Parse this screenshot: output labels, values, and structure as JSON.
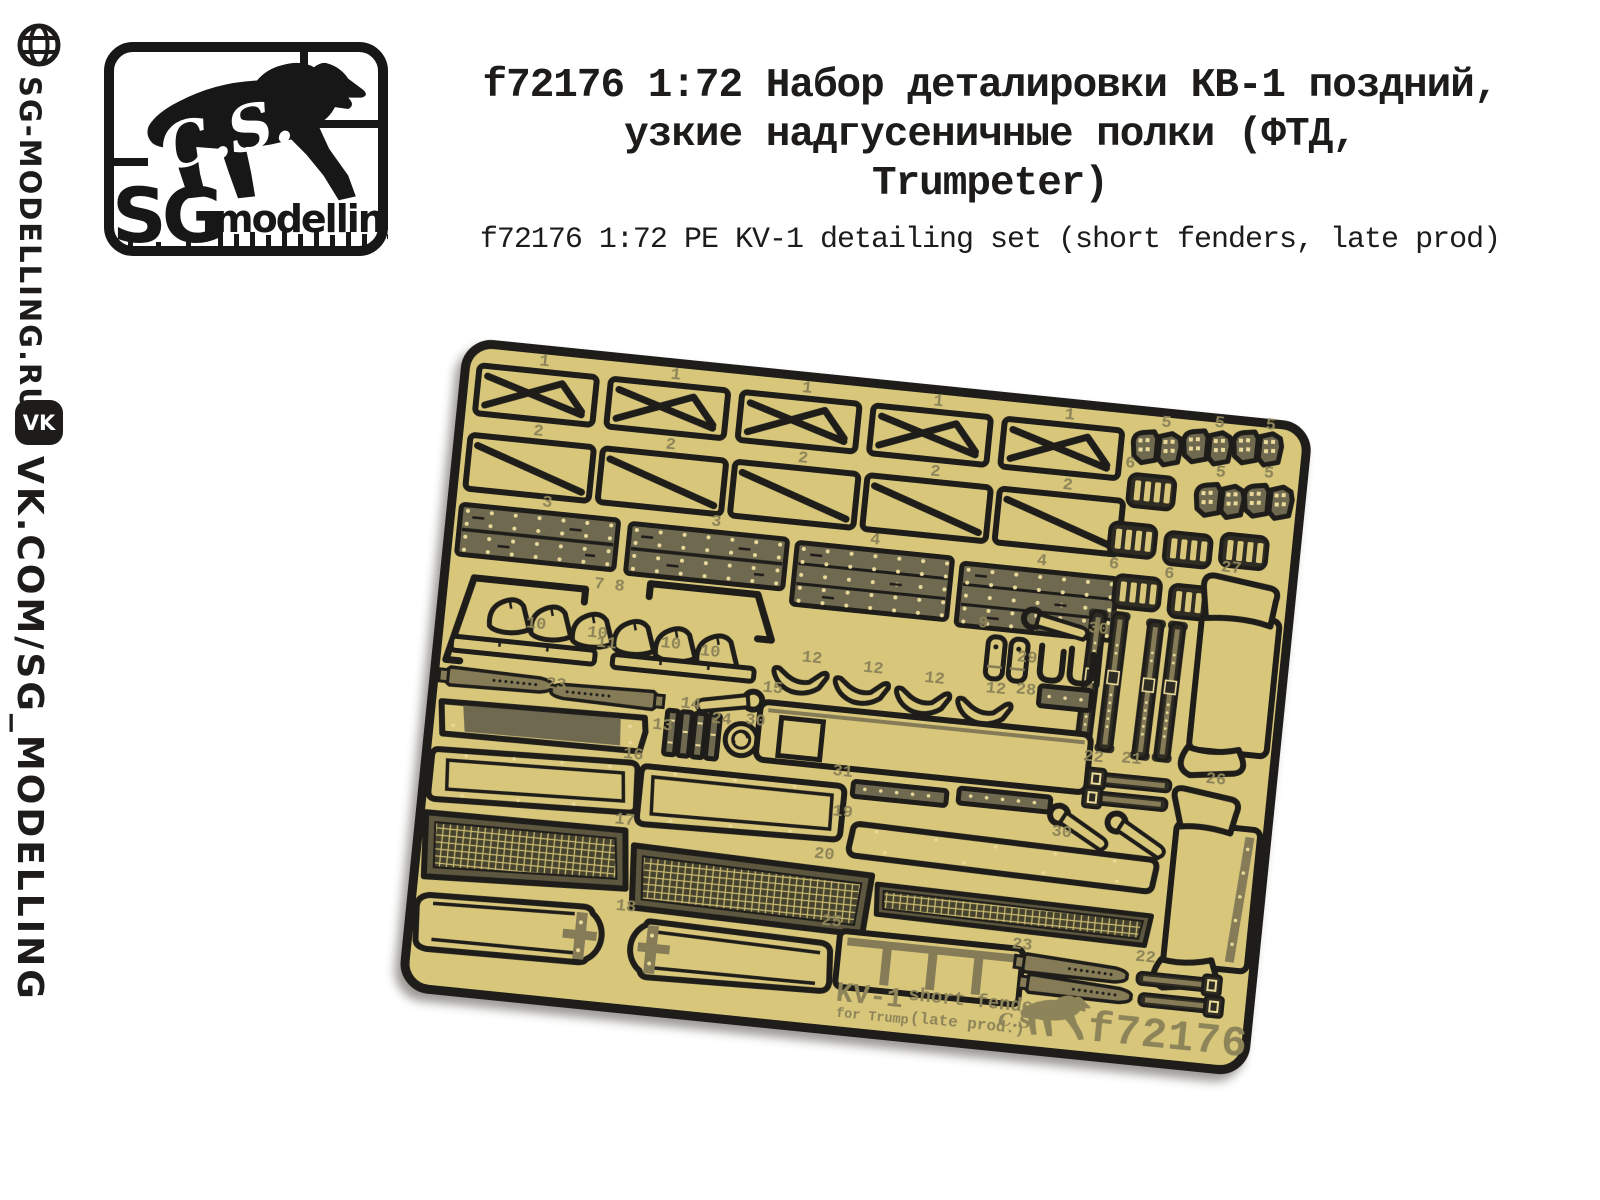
{
  "sidebar": {
    "site_url": "SG-MODELLING.RU",
    "vk_icon_text": "VK",
    "vk_url": "VK.COM/SG_MODELLING"
  },
  "logo": {
    "script_initials": "C.S.",
    "brand_main": "SG",
    "brand_sub": "modelling"
  },
  "header": {
    "title_line1": "f72176 1:72 Набор деталировки КВ-1 поздний,",
    "title_line2": "узкие надгусеничные полки (ФТД,",
    "title_line3": "Trumpeter)",
    "subtitle": "f72176 1:72 PE KV-1 detailing set (short fenders, late prod)"
  },
  "plate": {
    "footer": {
      "model": "KV-1",
      "variant": "short fenders",
      "for_line": "for Trump",
      "prod_line": "(late prod.)",
      "script_initials": "C.S.",
      "code": "f72176"
    },
    "part_labels": [
      {
        "t": "1",
        "x": 73,
        "y": 16
      },
      {
        "t": "1",
        "x": 205,
        "y": 16
      },
      {
        "t": "1",
        "x": 337,
        "y": 16
      },
      {
        "t": "1",
        "x": 469,
        "y": 16
      },
      {
        "t": "1",
        "x": 601,
        "y": 16
      },
      {
        "t": "2",
        "x": 74,
        "y": 86
      },
      {
        "t": "2",
        "x": 207,
        "y": 86
      },
      {
        "t": "2",
        "x": 340,
        "y": 86
      },
      {
        "t": "2",
        "x": 473,
        "y": 86
      },
      {
        "t": "2",
        "x": 606,
        "y": 86
      },
      {
        "t": "3",
        "x": 90,
        "y": 156
      },
      {
        "t": "3",
        "x": 260,
        "y": 158
      },
      {
        "t": "4",
        "x": 420,
        "y": 160
      },
      {
        "t": "4",
        "x": 588,
        "y": 164
      },
      {
        "t": "5",
        "x": 698,
        "y": 14
      },
      {
        "t": "5",
        "x": 751,
        "y": 9
      },
      {
        "t": "5",
        "x": 802,
        "y": 6
      },
      {
        "t": "5",
        "x": 757,
        "y": 58
      },
      {
        "t": "5",
        "x": 805,
        "y": 54
      },
      {
        "t": "6",
        "x": 666,
        "y": 58
      },
      {
        "t": "6",
        "x": 660,
        "y": 160
      },
      {
        "t": "6",
        "x": 716,
        "y": 164
      },
      {
        "t": "7 8",
        "x": 150,
        "y": 232
      },
      {
        "t": "9",
        "x": 536,
        "y": 232
      },
      {
        "t": "10",
        "x": 86,
        "y": 278
      },
      {
        "t": "10",
        "x": 148,
        "y": 281
      },
      {
        "t": "10",
        "x": 222,
        "y": 284
      },
      {
        "t": "10",
        "x": 262,
        "y": 288
      },
      {
        "t": "11",
        "x": 158,
        "y": 290
      },
      {
        "t": "12",
        "x": 364,
        "y": 284
      },
      {
        "t": "12",
        "x": 426,
        "y": 288
      },
      {
        "t": "12",
        "x": 488,
        "y": 292
      },
      {
        "t": "12",
        "x": 550,
        "y": 296
      },
      {
        "t": "13",
        "x": 222,
        "y": 366
      },
      {
        "t": "14",
        "x": 248,
        "y": 342
      },
      {
        "t": "15",
        "x": 328,
        "y": 318
      },
      {
        "t": "16",
        "x": 196,
        "y": 398
      },
      {
        "t": "17",
        "x": 194,
        "y": 464
      },
      {
        "t": "18",
        "x": 204,
        "y": 550
      },
      {
        "t": "19",
        "x": 410,
        "y": 434
      },
      {
        "t": "20",
        "x": 396,
        "y": 478
      },
      {
        "t": "21",
        "x": 692,
        "y": 352
      },
      {
        "t": "22",
        "x": 654,
        "y": 354
      },
      {
        "t": "22",
        "x": 726,
        "y": 548
      },
      {
        "t": "23",
        "x": 112,
        "y": 336
      },
      {
        "t": "23",
        "x": 602,
        "y": 548
      },
      {
        "t": "24",
        "x": 280,
        "y": 354
      },
      {
        "t": "25",
        "x": 410,
        "y": 544
      },
      {
        "t": "26",
        "x": 778,
        "y": 364
      },
      {
        "t": "27",
        "x": 772,
        "y": 152
      },
      {
        "t": "28",
        "x": 580,
        "y": 294
      },
      {
        "t": "29",
        "x": 578,
        "y": 262
      },
      {
        "t": "30",
        "x": 646,
        "y": 226
      },
      {
        "t": "30",
        "x": 314,
        "y": 352
      },
      {
        "t": "30",
        "x": 630,
        "y": 432
      },
      {
        "t": "31",
        "x": 406,
        "y": 394
      }
    ]
  },
  "colors": {
    "brass": "#d8c77b",
    "outline": "#1e1d1a",
    "olive": "#6f6950",
    "pale_dot": "#e9da9a",
    "label": "#8d8459"
  }
}
